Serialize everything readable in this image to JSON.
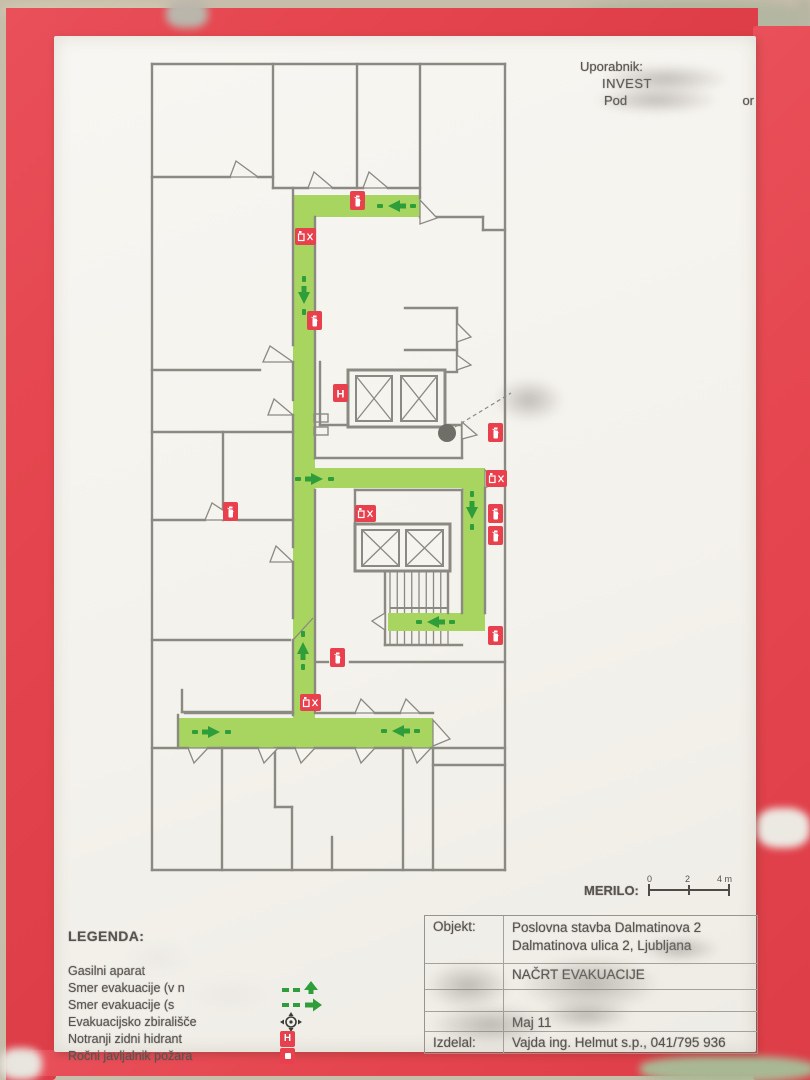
{
  "photo": {
    "tape_red": "#e5464f",
    "sheet": "#f5f3ee",
    "background_tan": "#c6bdab"
  },
  "user_block": {
    "line1": "Uporabnik:",
    "line2": "INVEST",
    "line3_left": "Pod",
    "line3_right": "or"
  },
  "scale": {
    "label": "MERILO:",
    "tick0": "0",
    "tick1": "2",
    "tick2": "4 m"
  },
  "legend": {
    "title": "LEGENDA:",
    "items": [
      {
        "label": "Gasilni aparat",
        "icon": "fire-extinguisher-icon"
      },
      {
        "label": "Smer evakuacije (v n",
        "icon": "evacuation-arrow-up-icon"
      },
      {
        "label": "Smer evakuacije (s",
        "icon": "evacuation-arrow-right-icon"
      },
      {
        "label": "Evakuacijsko zbirališče",
        "icon": "assembly-point-icon"
      },
      {
        "label": "Notranji zidni hidrant",
        "icon": "wall-hydrant-icon"
      },
      {
        "label": "Ročni javljalnik požara",
        "icon": "manual-fire-alarm-icon"
      }
    ]
  },
  "title_block": {
    "rows": [
      {
        "label": "Objekt:",
        "value": "Poslovna stavba Dalmatinova 2",
        "value2": "Dalmatinova ulica 2,  Ljubljana"
      },
      {
        "label": "",
        "value": "NAČRT EVAKUACIJE"
      },
      {
        "label": "",
        "value": ""
      },
      {
        "label": "",
        "value": "Maj  11"
      },
      {
        "label": "Izdelal:",
        "value": "Vajda ing. Helmut s.p., 041/795 936"
      }
    ]
  },
  "floor_plan": {
    "wall_color": "#8a8a82",
    "route_color": "#a7d55f",
    "arrow_color": "#2f9e3a",
    "icon_red": "#e8414d",
    "paper": "#f6f4ef",
    "route": [
      [
        143,
        133,
        127,
        22
      ],
      [
        143,
        133,
        22,
        553
      ],
      [
        143,
        406,
        192,
        20
      ],
      [
        312,
        406,
        23,
        163
      ],
      [
        238,
        551,
        97,
        18
      ],
      [
        28,
        656,
        255,
        30
      ]
    ],
    "walls": [
      [
        2,
        2,
        355,
        2
      ],
      [
        355,
        2,
        355,
        808
      ],
      [
        355,
        808,
        2,
        808
      ],
      [
        2,
        808,
        2,
        2
      ],
      [
        123,
        2,
        123,
        126
      ],
      [
        207,
        2,
        207,
        126
      ],
      [
        270,
        2,
        270,
        136
      ],
      [
        2,
        115,
        80,
        115
      ],
      [
        108,
        115,
        123,
        115
      ],
      [
        123,
        126,
        158,
        126
      ],
      [
        183,
        126,
        213,
        126
      ],
      [
        238,
        126,
        270,
        126
      ],
      [
        270,
        155,
        333,
        155
      ],
      [
        333,
        155,
        333,
        168
      ],
      [
        333,
        168,
        355,
        168
      ],
      [
        143,
        126,
        143,
        283
      ],
      [
        143,
        300,
        143,
        338
      ],
      [
        143,
        353,
        143,
        485
      ],
      [
        143,
        500,
        143,
        556
      ],
      [
        143,
        578,
        143,
        653
      ],
      [
        165,
        155,
        165,
        250
      ],
      [
        165,
        266,
        165,
        396
      ],
      [
        165,
        428,
        165,
        651
      ],
      [
        2,
        308,
        110,
        308
      ],
      [
        2,
        370,
        143,
        370
      ],
      [
        73,
        370,
        73,
        458
      ],
      [
        2,
        458,
        55,
        458
      ],
      [
        88,
        458,
        143,
        458
      ],
      [
        2,
        578,
        140,
        578
      ],
      [
        32,
        650,
        143,
        650
      ],
      [
        32,
        628,
        32,
        650
      ],
      [
        255,
        246,
        307,
        246
      ],
      [
        307,
        246,
        307,
        308
      ],
      [
        255,
        288,
        307,
        288
      ],
      [
        295,
        310,
        307,
        310
      ],
      [
        170,
        300,
        170,
        363
      ],
      [
        170,
        363,
        198,
        363
      ],
      [
        295,
        363,
        312,
        363
      ],
      [
        312,
        363,
        312,
        396
      ],
      [
        165,
        396,
        312,
        396
      ],
      [
        205,
        428,
        312,
        428
      ],
      [
        205,
        428,
        205,
        463
      ],
      [
        312,
        428,
        312,
        551
      ],
      [
        335,
        426,
        335,
        551
      ],
      [
        235,
        508,
        235,
        583
      ],
      [
        298,
        508,
        298,
        551
      ],
      [
        235,
        583,
        312,
        583
      ],
      [
        167,
        600,
        178,
        600
      ],
      [
        200,
        600,
        355,
        600
      ],
      [
        35,
        651,
        143,
        651
      ],
      [
        167,
        651,
        205,
        651
      ],
      [
        225,
        651,
        250,
        651
      ],
      [
        270,
        651,
        283,
        651
      ],
      [
        28,
        653,
        28,
        686
      ],
      [
        2,
        686,
        38,
        686
      ],
      [
        58,
        686,
        108,
        686
      ],
      [
        128,
        686,
        145,
        686
      ],
      [
        165,
        686,
        205,
        686
      ],
      [
        225,
        686,
        261,
        686
      ],
      [
        281,
        686,
        355,
        686
      ],
      [
        72,
        686,
        72,
        808
      ],
      [
        125,
        686,
        125,
        745
      ],
      [
        125,
        745,
        142,
        745
      ],
      [
        142,
        745,
        142,
        808
      ],
      [
        182,
        775,
        182,
        808
      ],
      [
        253,
        686,
        253,
        808
      ],
      [
        283,
        686,
        283,
        808
      ],
      [
        283,
        703,
        355,
        703
      ]
    ],
    "jambs": [
      [
        164,
        352,
        14,
        8
      ],
      [
        164,
        365,
        14,
        8
      ]
    ],
    "doors": [
      [
        80,
        115,
        108,
        115,
        86,
        99
      ],
      [
        158,
        126,
        183,
        126,
        164,
        110
      ],
      [
        213,
        126,
        238,
        126,
        219,
        110
      ],
      [
        270,
        138,
        270,
        162,
        287,
        156
      ],
      [
        113,
        300,
        143,
        300,
        120,
        284
      ],
      [
        118,
        353,
        143,
        353,
        124,
        337
      ],
      [
        55,
        458,
        88,
        458,
        62,
        441
      ],
      [
        120,
        500,
        143,
        500,
        126,
        484
      ],
      [
        307,
        261,
        307,
        280,
        321,
        275
      ],
      [
        307,
        293,
        307,
        308,
        321,
        303
      ],
      [
        312,
        360,
        312,
        377,
        327,
        373
      ],
      [
        335,
        408,
        335,
        426,
        349,
        419
      ],
      [
        235,
        551,
        235,
        568,
        222,
        559
      ],
      [
        205,
        651,
        225,
        651,
        211,
        637
      ],
      [
        250,
        651,
        270,
        651,
        256,
        637
      ],
      [
        283,
        658,
        283,
        684,
        300,
        677
      ],
      [
        38,
        686,
        58,
        686,
        44,
        701
      ],
      [
        108,
        686,
        128,
        686,
        114,
        701
      ],
      [
        145,
        686,
        165,
        686,
        151,
        701
      ],
      [
        205,
        686,
        225,
        686,
        211,
        701
      ],
      [
        261,
        686,
        281,
        686,
        267,
        701
      ]
    ],
    "door_leaf": [
      143,
      578,
      163,
      556
    ],
    "elevators": [
      {
        "outer": [
          198,
          308,
          97,
          57
        ],
        "cars": [
          [
            206,
            314,
            36,
            45
          ],
          [
            251,
            314,
            36,
            45
          ]
        ]
      },
      {
        "outer": [
          205,
          462,
          95,
          47
        ],
        "cars": [
          [
            212,
            468,
            37,
            36
          ],
          [
            256,
            468,
            37,
            36
          ]
        ]
      }
    ],
    "stairs": {
      "x": 240,
      "y": 508,
      "w": 58,
      "h": 75,
      "step": 7.25,
      "gap_top": 551,
      "gap_bottom": 569,
      "mid": 546
    },
    "arrows": [
      [
        248,
        144,
        "left"
      ],
      [
        154,
        232,
        "down"
      ],
      [
        163,
        417,
        "right"
      ],
      [
        322,
        447,
        "down"
      ],
      [
        287,
        560,
        "left"
      ],
      [
        153,
        590,
        "up"
      ],
      [
        60,
        670,
        "right"
      ],
      [
        252,
        669,
        "left"
      ]
    ],
    "icons": [
      [
        "ext",
        200,
        129
      ],
      [
        "combo",
        145,
        166
      ],
      [
        "ext",
        157,
        249
      ],
      [
        "hydrant",
        183,
        322
      ],
      [
        "ext",
        338,
        361
      ],
      [
        "combo",
        336,
        408
      ],
      [
        "ext",
        338,
        442
      ],
      [
        "ext",
        338,
        464
      ],
      [
        "combo",
        205,
        443
      ],
      [
        "ext",
        338,
        564
      ],
      [
        "ext",
        180,
        586
      ],
      [
        "combo",
        150,
        632
      ],
      [
        "ext",
        73,
        440
      ]
    ],
    "marker": {
      "cx": 297,
      "cy": 371,
      "r": 9
    },
    "pointer": [
      305,
      365,
      361,
      331
    ]
  }
}
